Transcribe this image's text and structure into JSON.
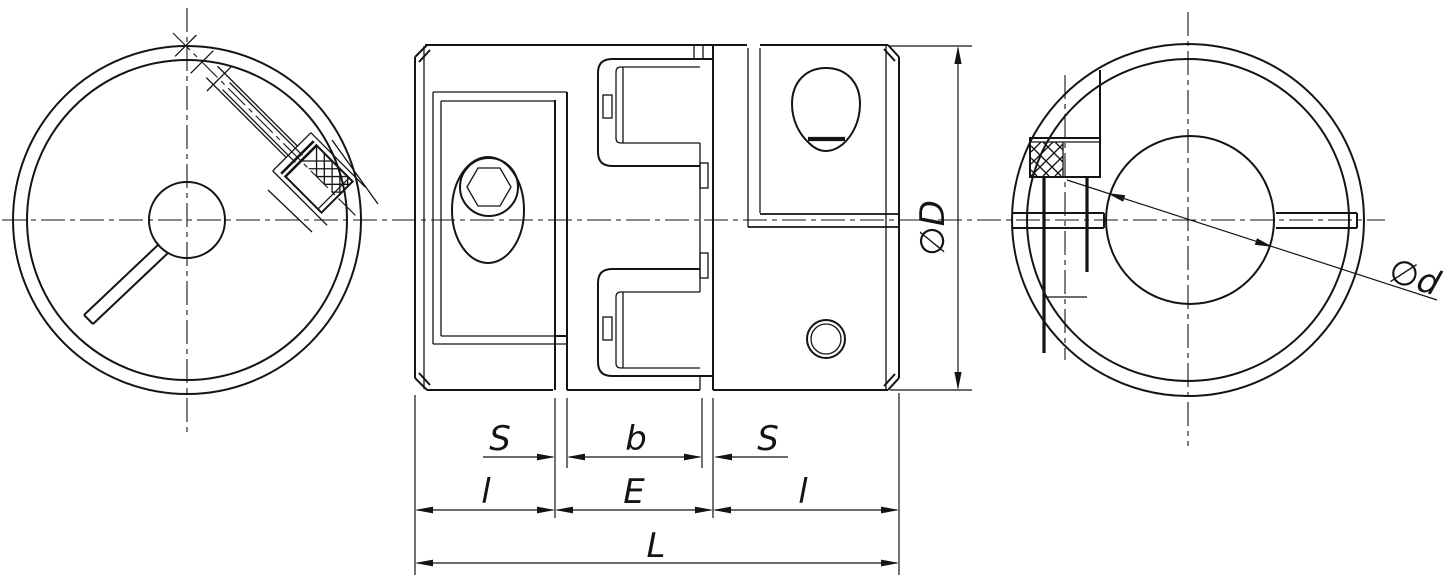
{
  "dimension_labels": {
    "s_left": "S",
    "spider_width": "b",
    "s_right": "S",
    "hub_length_left": "l",
    "between_hubs": "E",
    "hub_length_right": "l",
    "total_length": "L",
    "outer_diameter": "∅D",
    "bore_diameter": "∅d"
  },
  "style": {
    "line_color": "#141414",
    "background": "#ffffff"
  }
}
